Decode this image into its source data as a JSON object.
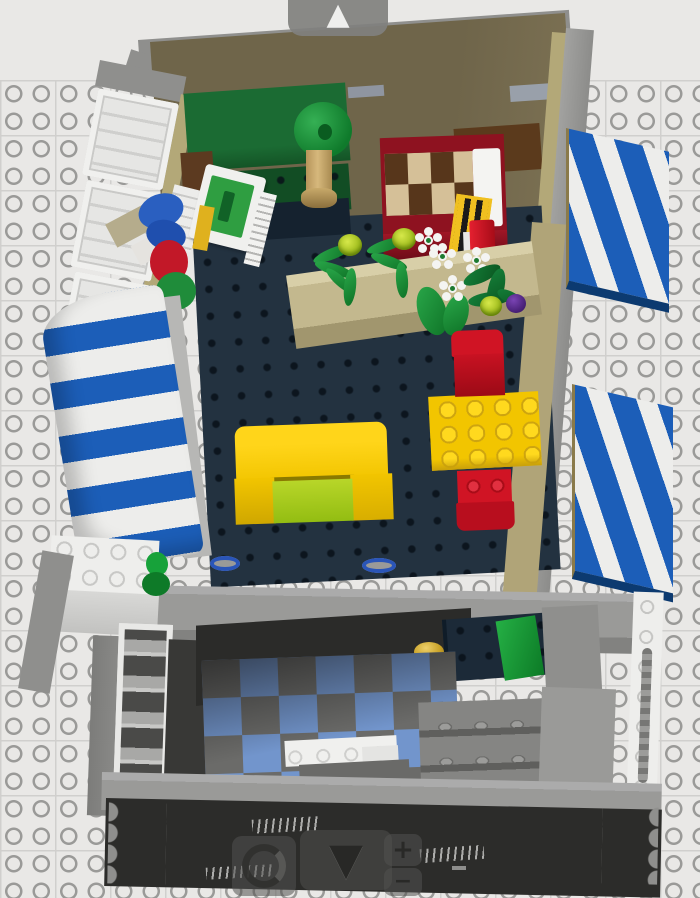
{
  "ui": {
    "camera_controls": {
      "pan_up": {
        "name": "pan-up-button",
        "glyph": "▲"
      },
      "pan_down": {
        "name": "pan-down-button",
        "glyph": "▼"
      },
      "rotate": {
        "name": "rotate-button"
      },
      "zoom_in": {
        "name": "zoom-in-button",
        "glyph": "+"
      },
      "zoom_out": {
        "name": "zoom-out-button",
        "glyph": "−"
      }
    }
  },
  "scene": {
    "type": "lego-3d-viewport",
    "baseplate": {
      "color": "#e9e8e6",
      "stud_outline_color": "#9a9a98"
    },
    "building": {
      "upper_floor": {
        "floor_far_color": "#6f654a",
        "floor_main_color": "#233240",
        "wall_tan_color": "#b3a878",
        "wall_gray_color": "#9a9a98",
        "parts": [
          "green-desk",
          "white-computer",
          "potted-tree",
          "red-bed-with-checkered-blanket",
          "white-pillow",
          "yellow-ladder",
          "red-extinguisher",
          "flower-planter",
          "palm-plant",
          "palm-plant",
          "white-flowers",
          "green-bush",
          "purple-fruit",
          "yellow-sofa",
          "yellow-table",
          "red-chair",
          "red-chair"
        ]
      },
      "awnings": {
        "stripe_blue": "#1c5eb8",
        "stripe_white": "#ededeb",
        "count": 3
      },
      "lower_floor": {
        "checker_colors": [
          "#7295cc",
          "#6b6b69"
        ],
        "parts": [
          "navy-counter",
          "gold-knob",
          "green-door-ramp",
          "white-counter",
          "gray-stairs",
          "white-barred-door",
          "white-door-frame"
        ]
      },
      "facade": {
        "front_wall_color": "#2c2c2a",
        "cap_color": "#9a9a98",
        "accent_gold": "#d4ab2a"
      }
    }
  }
}
